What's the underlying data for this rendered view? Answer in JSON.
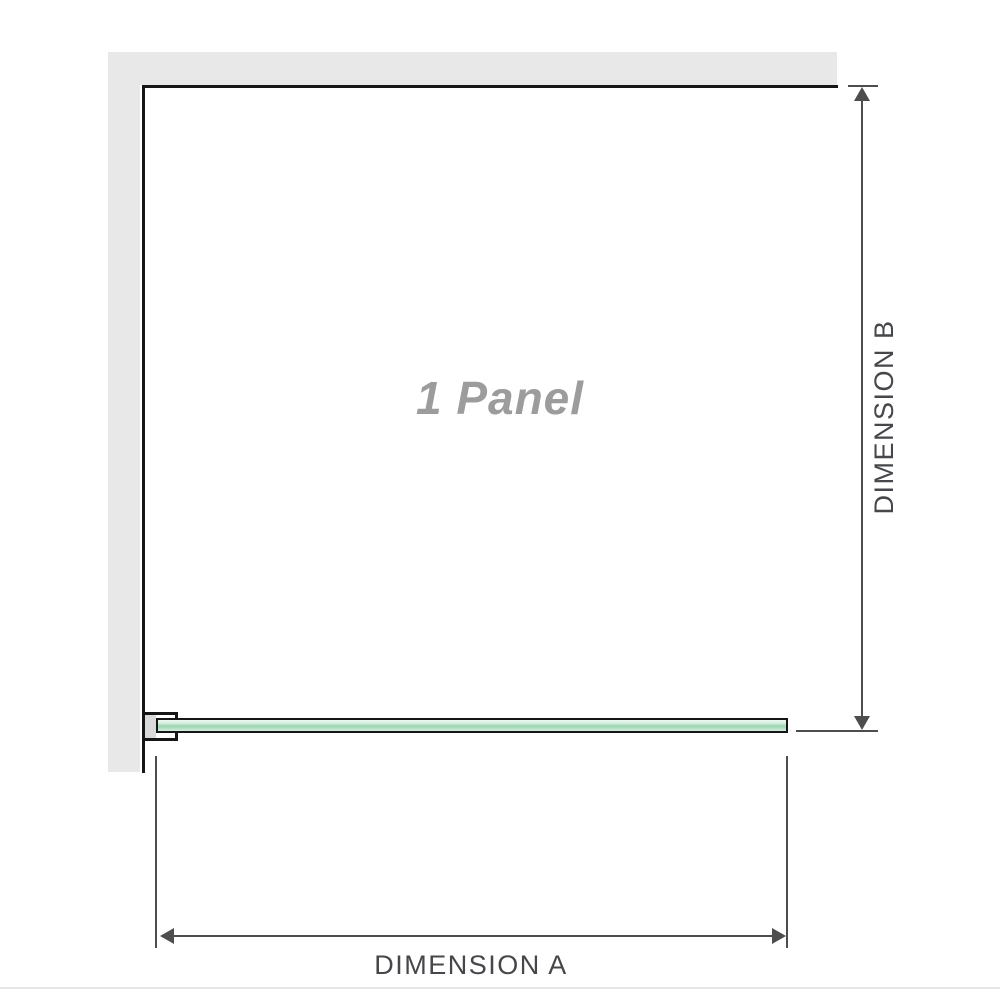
{
  "diagram": {
    "panel_label": "1 Panel",
    "dimensions": {
      "a_label": "DIMENSION A",
      "b_label": "DIMENSION B"
    }
  },
  "colors": {
    "wall_fill": "#e8e8e8",
    "wall_line": "#161616",
    "dimension_line": "#4d4d4d",
    "label_text": "#45474a",
    "panel_label_text": "#9c9c9c",
    "glass_hi": "#eef8f2",
    "glass_light": "#d5eedf",
    "glass_mid": "#b2dfc3",
    "glass_dark": "#9cd6b0",
    "bracket_fill": "#dadada",
    "divider": "#e6e6e6"
  }
}
